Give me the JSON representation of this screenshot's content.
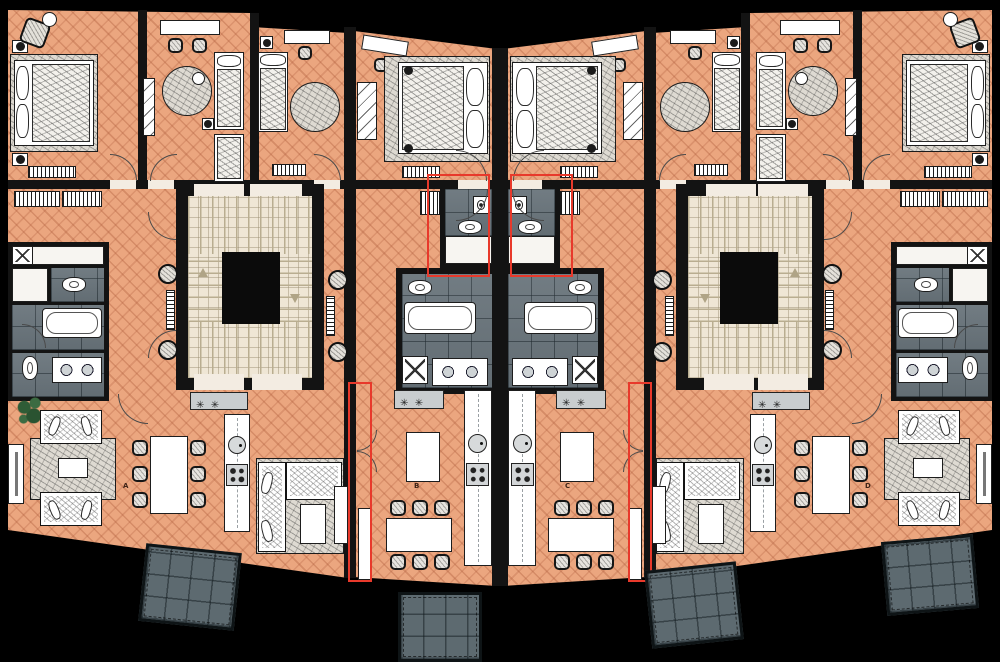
{
  "meta": {
    "description": "Architectural floor plan of a residential storey: four apartments (A, B, C, D) arranged symmetrically around two stair/elevator cores, with bedrooms along the top, bathrooms in the middle band, living/dining/kitchen areas at the bottom and balconies projecting from the lower facade.",
    "visible_text": [
      "A",
      "B",
      "C",
      "D"
    ]
  },
  "palette": {
    "background": "#000000",
    "walls": "#131313",
    "wood_floor": "#eba67f",
    "wood_floor_joint": "#b15f3e",
    "bathroom_tile": "#6a757c",
    "stair_tile": "#efe6d5",
    "elevator_core": "#0b0b0b",
    "balcony_deck": "#5d6a70",
    "furniture_white": "#ffffff",
    "outline": "#1d1d1d",
    "highlight_red": "#e8392b",
    "label_color": "#3f2417",
    "plant_green": "#2f5c36"
  },
  "apartments": [
    {
      "id": "A",
      "label": "A",
      "wing": "west outer",
      "rooms": [
        "bedroom-1",
        "bedroom-2",
        "bedroom-3",
        "hallway",
        "bathroom",
        "wc",
        "living-room",
        "dining-area",
        "kitchen"
      ],
      "balcony": true
    },
    {
      "id": "B",
      "label": "B",
      "wing": "center west",
      "rooms": [
        "bedroom",
        "hallway",
        "utility-room",
        "bathroom",
        "kitchen",
        "dining-area",
        "living-area"
      ],
      "balcony": true
    },
    {
      "id": "C",
      "label": "C",
      "wing": "center east",
      "rooms": [
        "bedroom",
        "hallway",
        "utility-room",
        "bathroom",
        "kitchen",
        "dining-area",
        "living-area"
      ],
      "balcony": true
    },
    {
      "id": "D",
      "label": "D",
      "wing": "east outer",
      "rooms": [
        "bedroom-1",
        "bedroom-2",
        "bedroom-3",
        "hallway",
        "bathroom",
        "wc",
        "living-room",
        "dining-area",
        "kitchen"
      ],
      "balcony": true
    }
  ],
  "circulation": {
    "stair_cores": [
      {
        "name": "west-stair-core",
        "features": [
          "switchback-stair",
          "elevator-shaft",
          "landings"
        ]
      },
      {
        "name": "east-stair-core",
        "features": [
          "switchback-stair",
          "elevator-shaft",
          "landings"
        ]
      }
    ]
  },
  "annotations": {
    "red_outlines": [
      "utility-room-B",
      "utility-room-C",
      "party-wall-entry-A-B",
      "party-wall-entry-C-D"
    ]
  },
  "legend_icons": [
    "bed-icon",
    "rug-icon",
    "wardrobe-icon",
    "desk-icon",
    "chair-icon",
    "sofa-icon",
    "coffee-table-icon",
    "dining-table-icon",
    "kitchen-counter-icon",
    "kitchen-island-icon",
    "sink-icon",
    "cooktop-icon",
    "toilet-icon",
    "bathtub-icon",
    "double-washbasin-icon",
    "washing-machine-icon",
    "radiator-icon",
    "pouf-icon",
    "floor-lamp-icon",
    "plant-icon",
    "tv-sideboard-icon",
    "door-swing-icon",
    "stair-arrow-icon",
    "balcony-icon"
  ]
}
